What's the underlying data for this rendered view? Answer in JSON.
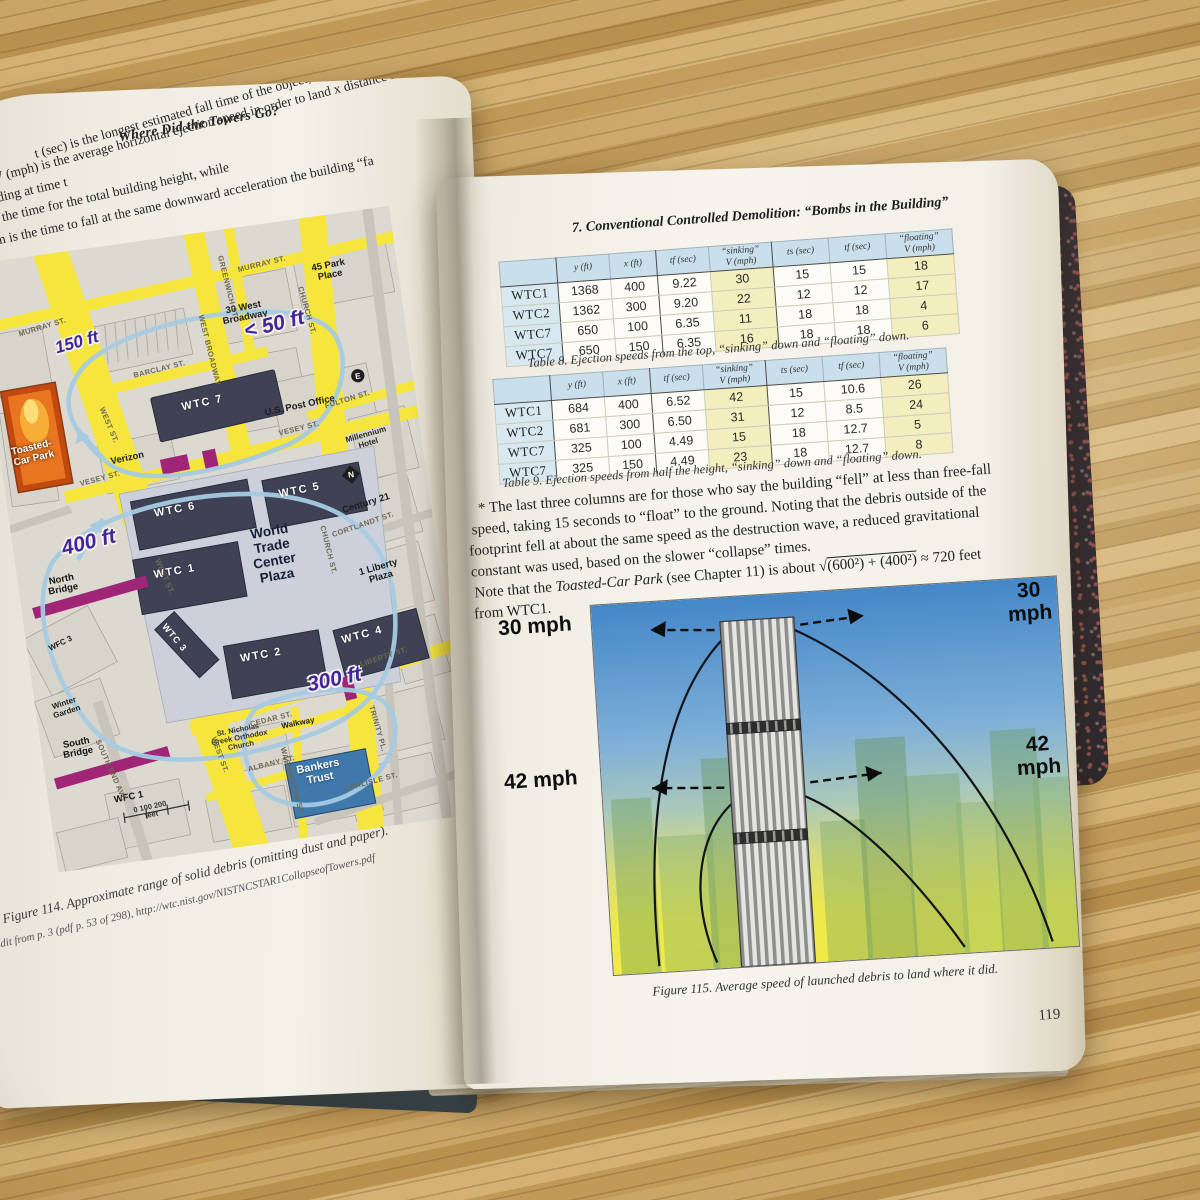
{
  "colors": {
    "map_street_yellow": "#f6e53c",
    "wtc_building_dark": "#3e4254",
    "bankers_trust_blue": "#3f79ab",
    "debris_loop_blue": "#a6cbe2",
    "bridge_magenta": "#a12577",
    "distance_label_purple": "#40269a",
    "table_header_blue": "#c9dfeb",
    "table_highlight_yellow": "#f3eebd",
    "figure_sky_blue": "#4487c8",
    "figure_ground_yellow": "#f0ea45",
    "page_cream": "#f3f0e8",
    "wood_tan": "#c4a05f"
  },
  "left_page": {
    "running_header": "Where Did the Towers Go?",
    "intro_lines": [
      "t (sec) is the longest estimated fall time of the object,",
      "V (mph) is the average horizontal ejection speed in order to land x distance fr",
      "building at time t",
      "ts is the time for the total building height, while",
      "tf,lim is the time to fall at the same downward acceleration the building “fa"
    ],
    "figure_caption_line1": "Figure 114. Approximate range of solid debris (omitting dust and paper).",
    "figure_caption_line2": "Edit from p. 3 (pdf p. 53 of 298), http://wtc.nist.gov/NISTNCSTAR1CollapseofTowers.pdf",
    "map": {
      "labels": [
        {
          "t": "WTC 7",
          "x": 208,
          "y": 170,
          "r": -4,
          "c": "wtc",
          "n": "map-label-wtc7"
        },
        {
          "t": "WTC 6",
          "x": 166,
          "y": 272,
          "r": -3,
          "c": "wtc",
          "n": "map-label-wtc6"
        },
        {
          "t": "WTC 5",
          "x": 292,
          "y": 270,
          "r": -3,
          "c": "wtc",
          "n": "map-label-wtc5"
        },
        {
          "t": "WTC 1",
          "x": 157,
          "y": 333,
          "r": -2,
          "c": "wtc",
          "n": "map-label-wtc1"
        },
        {
          "t": "WTC 3",
          "x": 147,
          "y": 398,
          "r": 58,
          "c": "wtcsm",
          "n": "map-label-wtc3"
        },
        {
          "t": "WTC 2",
          "x": 231,
          "y": 428,
          "r": -2,
          "c": "wtc",
          "n": "map-label-wtc2"
        },
        {
          "t": "WTC 4",
          "x": 334,
          "y": 422,
          "r": -7,
          "c": "wtc",
          "n": "map-label-wtc4"
        },
        {
          "t": "World\nTrade\nCenter\nPlaza",
          "x": 257,
          "y": 328,
          "r": -2,
          "c": "plaza",
          "n": "map-label-wtc-plaza"
        },
        {
          "t": "Verizon",
          "x": 126,
          "y": 214,
          "r": -4,
          "c": "gray",
          "n": "map-label-verizon"
        },
        {
          "t": "U.S. Post Office",
          "x": 304,
          "y": 186,
          "r": -4,
          "c": "gray",
          "n": "map-label-post-office"
        },
        {
          "t": "30 West\nBroadway",
          "x": 262,
          "y": 86,
          "r": -3,
          "c": "gray",
          "n": "map-label-30-west-broadway"
        },
        {
          "t": "45 Park\nPlace",
          "x": 352,
          "y": 56,
          "r": -3,
          "c": "gray",
          "n": "map-label-45-park-place"
        },
        {
          "t": "Millennium\nHotel",
          "x": 366,
          "y": 228,
          "r": -8,
          "c": "graysm",
          "n": "map-label-millennium-hotel"
        },
        {
          "t": "Century 21",
          "x": 356,
          "y": 292,
          "r": -9,
          "c": "gray",
          "n": "map-label-century-21"
        },
        {
          "t": "1 Liberty\nPlaza",
          "x": 360,
          "y": 362,
          "r": -8,
          "c": "gray",
          "n": "map-label-1-liberty-plaza"
        },
        {
          "t": "Toasted-\nCar Park",
          "x": 33,
          "y": 196,
          "r": -5,
          "c": "toast",
          "n": "map-label-toasted-car-park"
        },
        {
          "t": "North\nBridge",
          "x": 44,
          "y": 330,
          "r": -3,
          "c": "misc",
          "n": "map-label-north-bridge"
        },
        {
          "t": "South\nBridge",
          "x": 36,
          "y": 494,
          "r": -3,
          "c": "misc",
          "n": "map-label-south-bridge"
        },
        {
          "t": "WFC 3",
          "x": 34,
          "y": 388,
          "r": -18,
          "c": "miscsm",
          "n": "map-label-wfc3"
        },
        {
          "t": "Winter\nGarden",
          "x": 30,
          "y": 452,
          "r": -10,
          "c": "miscsm",
          "n": "map-label-winter-garden"
        },
        {
          "t": "WFC 1",
          "x": 80,
          "y": 550,
          "r": -3,
          "c": "misc",
          "n": "map-label-wfc1"
        },
        {
          "t": "St. Nicholas\nGreek Orthodox\nChurch",
          "x": 198,
          "y": 506,
          "r": -3,
          "c": "tiny",
          "n": "map-label-st-nicholas-church"
        },
        {
          "t": "Walkway",
          "x": 258,
          "y": 500,
          "r": -3,
          "c": "miscsm",
          "n": "map-label-walkway"
        },
        {
          "t": "Bankers\nTrust",
          "x": 272,
          "y": 552,
          "r": -3,
          "c": "bankers",
          "n": "map-label-bankers-trust"
        },
        {
          "t": "MURRAY ST.",
          "x": 60,
          "y": 72,
          "r": -9,
          "c": "st",
          "n": "map-street-murray"
        },
        {
          "t": "MURRAY ST.",
          "x": 286,
          "y": 40,
          "r": -6,
          "c": "st",
          "n": "map-street-murray"
        },
        {
          "t": "BARCLAY ST.",
          "x": 170,
          "y": 130,
          "r": -6,
          "c": "st",
          "n": "map-street-barclay"
        },
        {
          "t": "VESEY ST.",
          "x": 96,
          "y": 230,
          "r": -7,
          "c": "st",
          "n": "map-street-vesey"
        },
        {
          "t": "VESEY ST.",
          "x": 300,
          "y": 208,
          "r": -6,
          "c": "st",
          "n": "map-street-vesey"
        },
        {
          "t": "WEST BROADWAY",
          "x": 222,
          "y": 118,
          "r": 84,
          "c": "st",
          "n": "map-street-west-broadway"
        },
        {
          "t": "GREENWICH ST.",
          "x": 249,
          "y": 58,
          "r": 84,
          "c": "st",
          "n": "map-street-greenwich"
        },
        {
          "t": "CHURCH ST.",
          "x": 324,
          "y": 92,
          "r": 82,
          "c": "st",
          "n": "map-street-church"
        },
        {
          "t": "CHURCH ST.",
          "x": 312,
          "y": 332,
          "r": 84,
          "c": "st",
          "n": "map-street-church"
        },
        {
          "t": "WEST ST.",
          "x": 112,
          "y": 178,
          "r": 75,
          "c": "st",
          "n": "map-street-west"
        },
        {
          "t": "WEST ST.",
          "x": 146,
          "y": 336,
          "r": 74,
          "c": "st",
          "n": "map-street-west"
        },
        {
          "t": "WEST ST.",
          "x": 176,
          "y": 520,
          "r": 78,
          "c": "st",
          "n": "map-street-west"
        },
        {
          "t": "FULTON ST.",
          "x": 352,
          "y": 186,
          "r": -9,
          "c": "st",
          "n": "map-street-fulton"
        },
        {
          "t": "CORTLANDT ST.",
          "x": 350,
          "y": 312,
          "r": -11,
          "c": "st",
          "n": "map-street-cortlandt"
        },
        {
          "t": "LIBERTY ST.",
          "x": 352,
          "y": 446,
          "r": -10,
          "c": "st",
          "n": "map-street-liberty"
        },
        {
          "t": "CEDAR ST.",
          "x": 232,
          "y": 492,
          "r": -6,
          "c": "st",
          "n": "map-street-cedar"
        },
        {
          "t": "ALBANY ST.",
          "x": 226,
          "y": 536,
          "r": -6,
          "c": "st",
          "n": "map-street-albany"
        },
        {
          "t": "CARLISLE ST.",
          "x": 322,
          "y": 568,
          "r": -7,
          "c": "st",
          "n": "map-street-carlisle"
        },
        {
          "t": "WASHINGTON ST.",
          "x": 244,
          "y": 556,
          "r": 82,
          "c": "st",
          "n": "map-street-washington"
        },
        {
          "t": "TRINITY PL.",
          "x": 336,
          "y": 516,
          "r": 82,
          "c": "st",
          "n": "map-street-trinity"
        },
        {
          "t": "SOUTH END AVE",
          "x": 66,
          "y": 520,
          "r": 74,
          "c": "st",
          "n": "map-street-south-end"
        },
        {
          "t": "150 ft",
          "x": 92,
          "y": 92,
          "r": -8,
          "c": "dist",
          "n": "map-distance-150ft"
        },
        {
          "t": "< 50 ft",
          "x": 290,
          "y": 102,
          "r": -6,
          "c": "distbig",
          "n": "map-distance-50ft"
        },
        {
          "t": "400 ft",
          "x": 76,
          "y": 292,
          "r": -6,
          "c": "distbig",
          "n": "map-distance-400ft"
        },
        {
          "t": "300 ft",
          "x": 300,
          "y": 462,
          "r": -4,
          "c": "distbig",
          "n": "map-distance-300ft"
        },
        {
          "t": "0   100  200\nfeet",
          "x": 100,
          "y": 566,
          "r": -4,
          "c": "tiny",
          "n": "map-scale-bar"
        }
      ]
    }
  },
  "right_page": {
    "chapter_header": "7. Conventional Controlled Demolition: “Bombs in the Building”",
    "table8": {
      "headers": [
        "",
        "y (ft)",
        "x (ft)",
        "tf (sec)",
        "“sinking”\nV (mph)",
        "ts (sec)",
        "tf (sec)",
        "“floating”\nV (mph)"
      ],
      "highlight_cols": [
        4,
        7
      ],
      "rows": [
        [
          "WTC1",
          "1368",
          "400",
          "9.22",
          "30",
          "15",
          "15",
          "18"
        ],
        [
          "WTC2",
          "1362",
          "300",
          "9.20",
          "22",
          "12",
          "12",
          "17"
        ],
        [
          "WTC7",
          "650",
          "100",
          "6.35",
          "11",
          "18",
          "18",
          "4"
        ],
        [
          "WTC7",
          "650",
          "150",
          "6.35",
          "16",
          "18",
          "18",
          "6"
        ]
      ],
      "caption": "Table 8. Ejection speeds from the top, “sinking” down and “floating” down."
    },
    "table9": {
      "headers": [
        "",
        "y (ft)",
        "x (ft)",
        "tf (sec)",
        "“sinking”\nV (mph)",
        "ts (sec)",
        "tf (sec)",
        "“floating”\nV (mph)"
      ],
      "highlight_cols": [
        4,
        7
      ],
      "rows": [
        [
          "WTC1",
          "684",
          "400",
          "6.52",
          "42",
          "15",
          "10.6",
          "26"
        ],
        [
          "WTC2",
          "681",
          "300",
          "6.50",
          "31",
          "12",
          "8.5",
          "24"
        ],
        [
          "WTC7",
          "325",
          "100",
          "4.49",
          "15",
          "18",
          "12.7",
          "5"
        ],
        [
          "WTC7",
          "325",
          "150",
          "4.49",
          "23",
          "18",
          "12.7",
          "8"
        ]
      ],
      "caption": "Table 9. Ejection speeds from half the height, “sinking” down and “floating” down."
    },
    "footnote_lines": [
      "* The last three columns are for those who say the building “fell” at less than free-fall",
      "speed, taking 15 seconds to “float” to the ground. Noting that the debris outside of the",
      "footprint fell at about the same speed as the destruction wave, a reduced gravitational",
      "constant was used, based on the slower “collapse” times."
    ],
    "note": {
      "pre": "Note that the ",
      "em": "Toasted-Car Park",
      "mid": " (see Chapter 11) is about ",
      "radical": "√",
      "radicand": "(600²) + (400²)",
      "post": " ≈ 720 feet",
      "line2": "from WTC1."
    },
    "figure115": {
      "speed_labels": [
        {
          "t": "30 mph",
          "x": 85,
          "y": 452,
          "r": -2,
          "c": "speed",
          "n": "speed-label-30mph-left"
        },
        {
          "t": "30 mph",
          "x": 580,
          "y": 443,
          "r": -2,
          "c": "speed",
          "n": "speed-label-30mph-right"
        },
        {
          "t": "42 mph",
          "x": 86,
          "y": 606,
          "r": -2,
          "c": "speed",
          "n": "speed-label-42mph-left"
        },
        {
          "t": "42 mph",
          "x": 584,
          "y": 597,
          "r": -2,
          "c": "speed",
          "n": "speed-label-42mph-right"
        }
      ],
      "caption": "Figure 115. Average speed of launched debris to land where it did."
    },
    "page_number": "119"
  }
}
